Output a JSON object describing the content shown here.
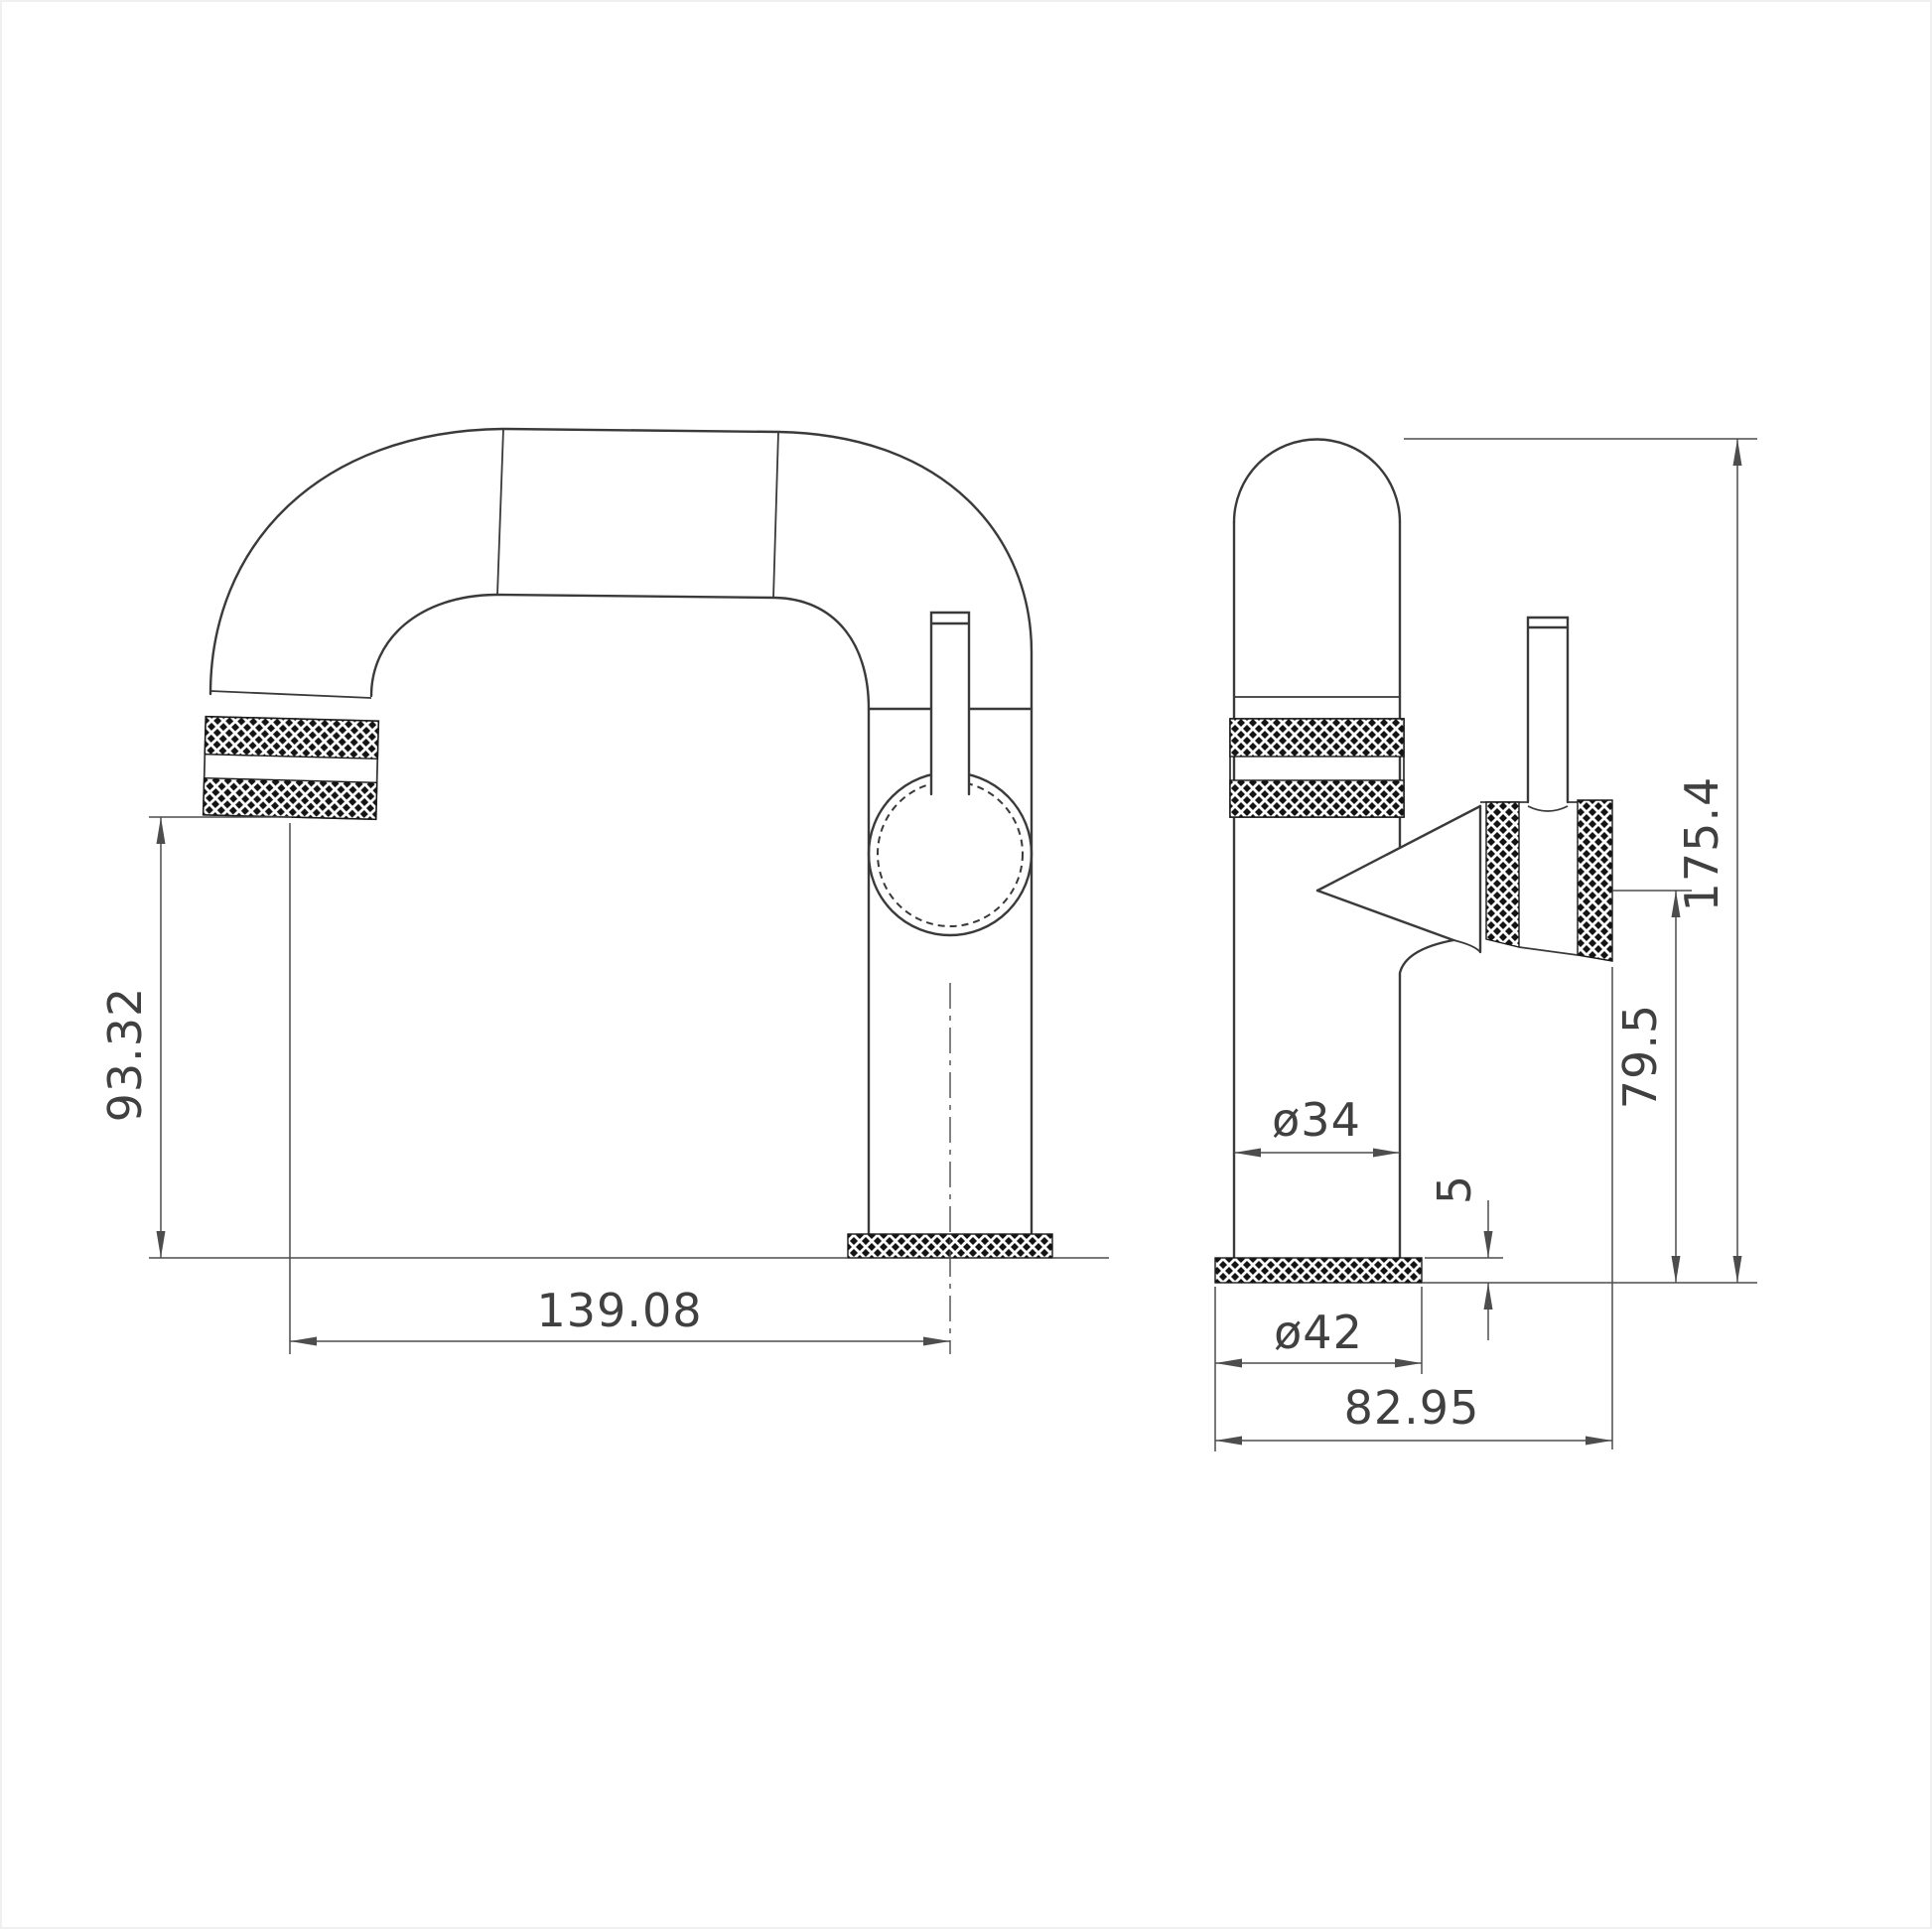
{
  "drawing": {
    "kind": "technical-dimension-drawing",
    "subject": "monobloc basin mixer tap, two orthographic views",
    "background": "#ffffff",
    "object_line_color": "#3a3a3a",
    "dimension_line_color": "#4d4d4d",
    "text_color": "#404040",
    "knurl_color": "#141414"
  },
  "views": {
    "front": {
      "name": "front view",
      "dims": {
        "spout_clearance": "93.32",
        "spout_reach": "139.08"
      }
    },
    "side": {
      "name": "side view",
      "dims": {
        "overall_height": "175.4",
        "handle_centre_height": "79.5",
        "body_diameter": "ø34",
        "base_height": "5",
        "base_diameter": "ø42",
        "overall_depth": "82.95"
      }
    }
  }
}
